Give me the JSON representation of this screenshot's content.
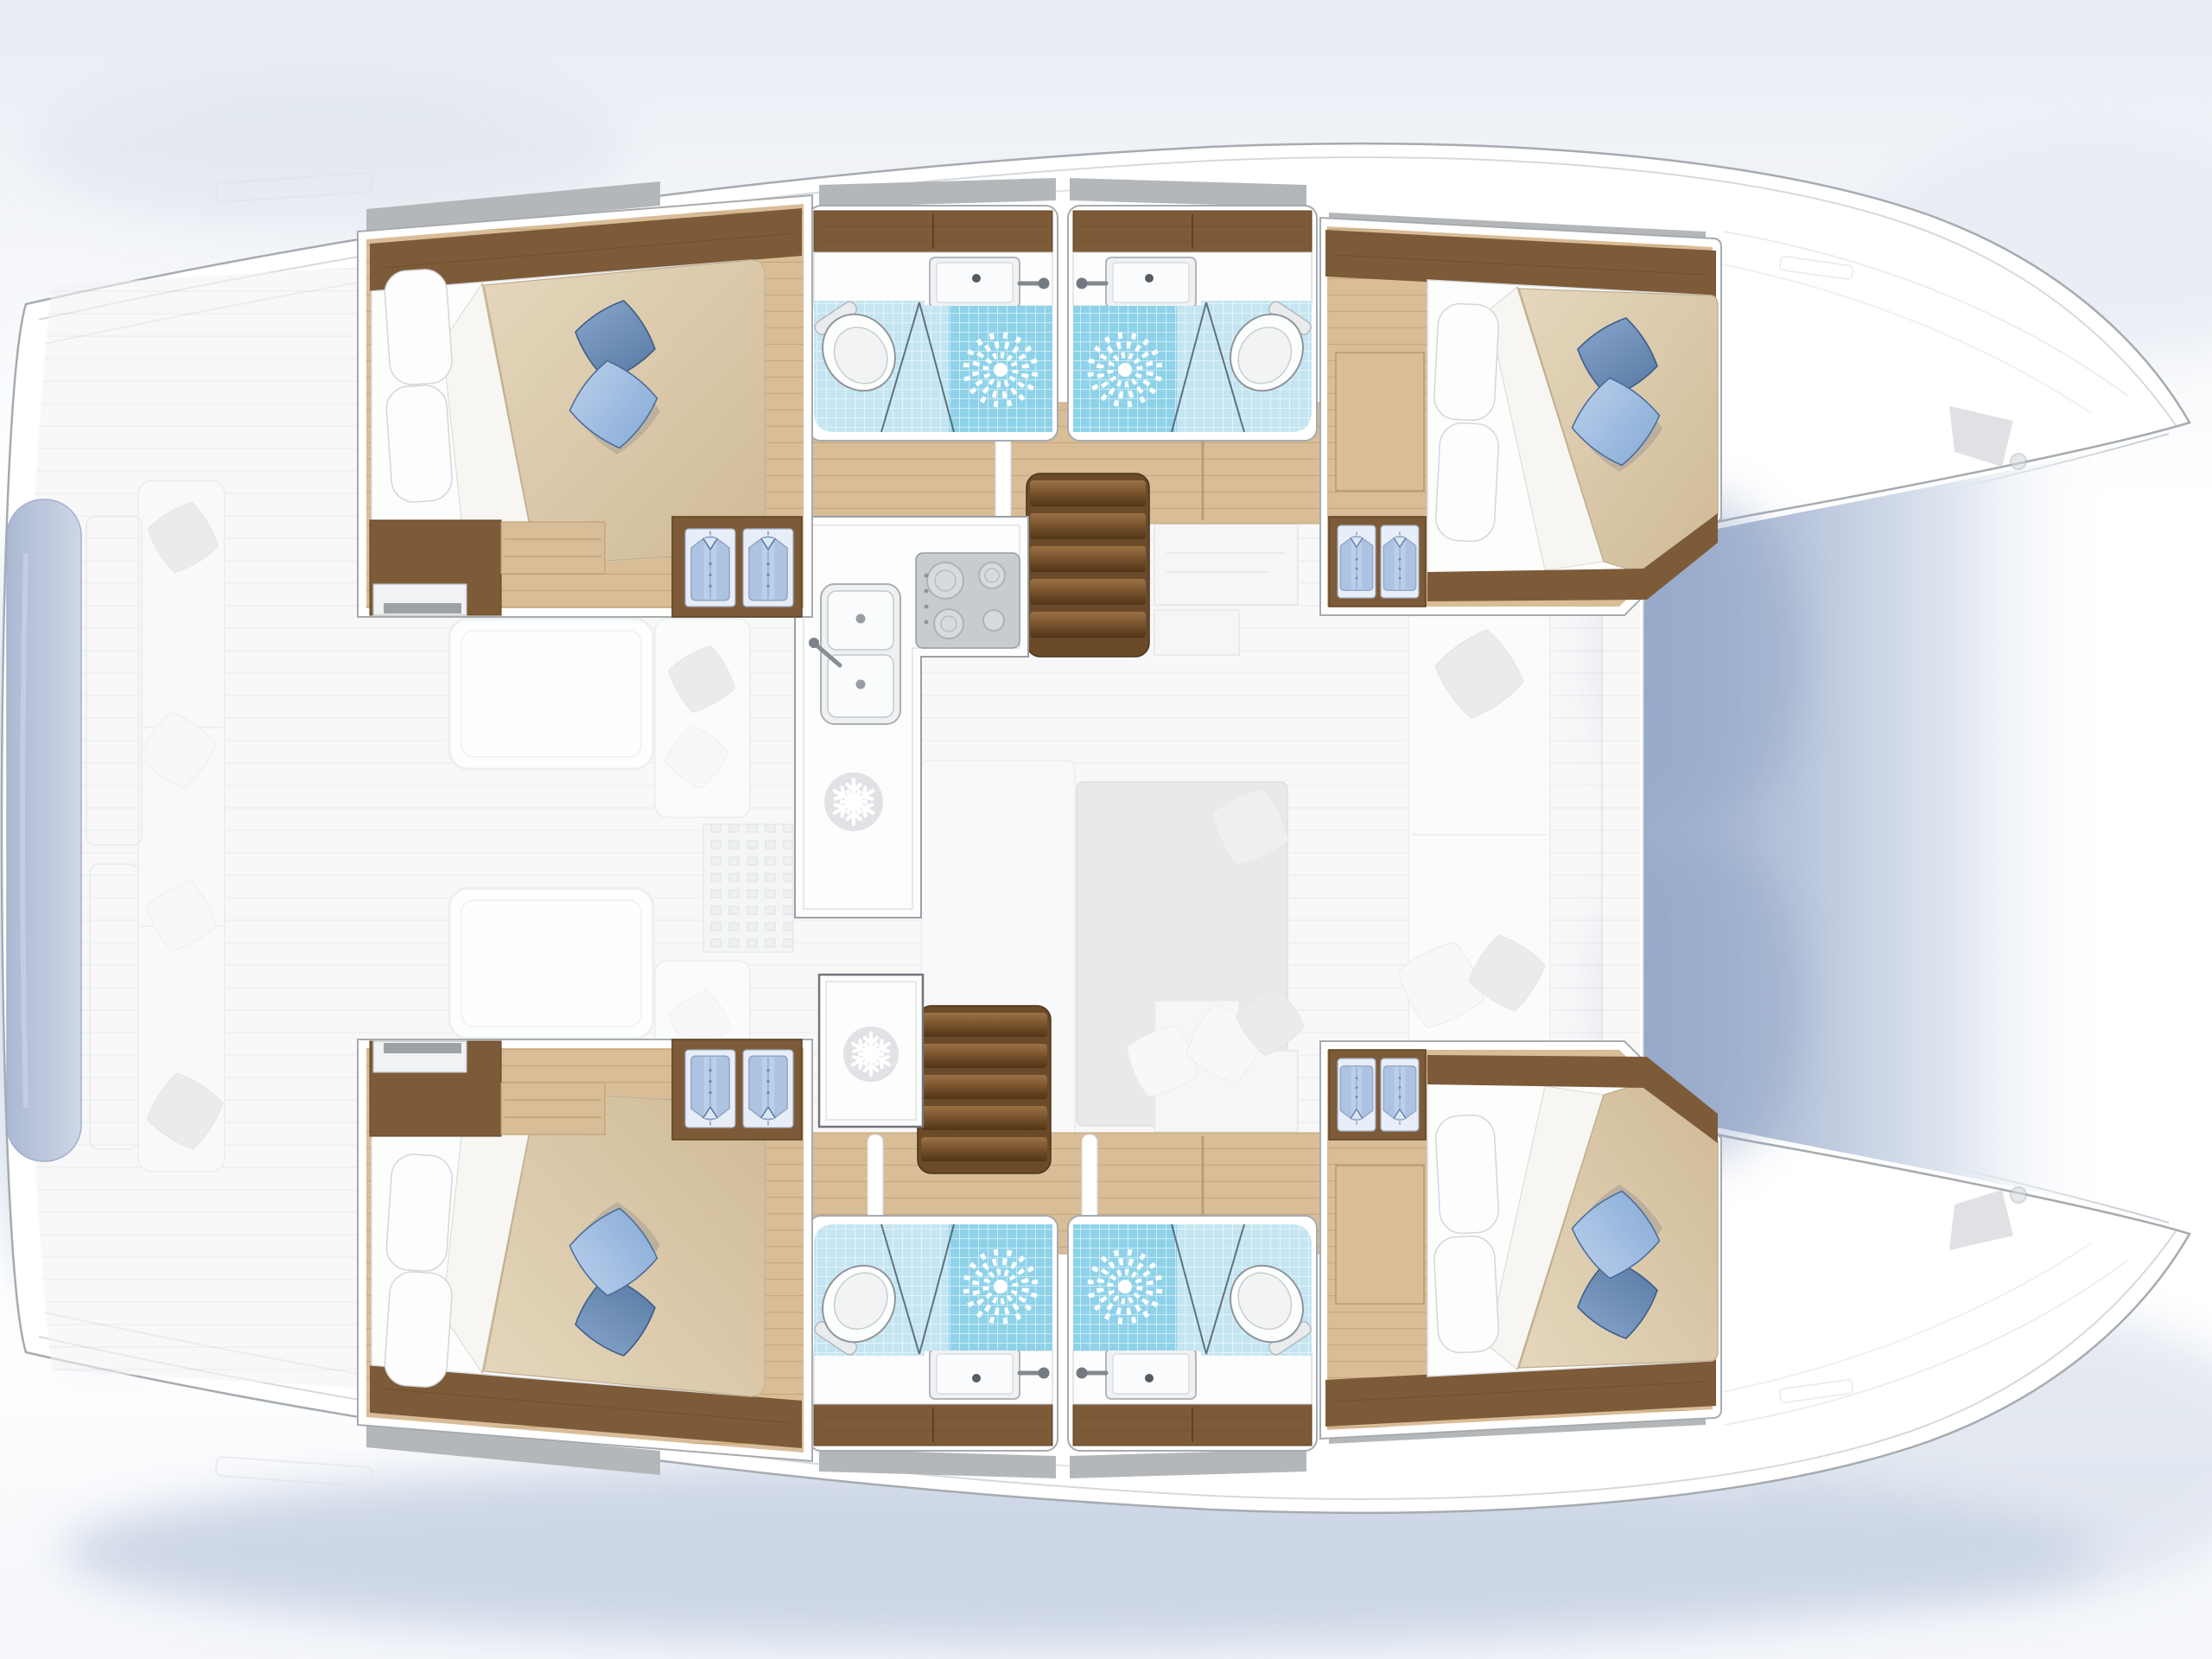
{
  "diagram": {
    "type": "boat-floor-plan",
    "vessel": "sailing catamaran, top-down interior layout, bows pointing right",
    "visible_text": "",
    "counts": {
      "double_cabins": 4,
      "bathrooms": 4,
      "toilets": 4,
      "showers": 4,
      "bathroom_sinks": 4,
      "galley_sink_basins": 2,
      "cooktop_burners": 4,
      "refrigerator_icons": 2,
      "wardrobes": 4,
      "hanging_shirts": 8,
      "companionway_stairs": 2
    }
  },
  "rooms_map": {
    "boat": "Catamaran interior floor plan with 4 double cabins and 4 bathrooms",
    "cabin-port-aft": "Port aft double cabin",
    "cabin-port-fwd": "Port forward double cabin",
    "cabin-stbd-aft": "Starboard aft double cabin",
    "cabin-stbd-fwd": "Starboard forward double cabin",
    "head-port-aft": "Port aft bathroom with sink, toilet and shower",
    "head-port-fwd": "Port forward bathroom with sink, toilet and shower",
    "head-stbd-aft": "Starboard aft bathroom with sink, toilet and shower",
    "head-stbd-fwd": "Starboard forward bathroom with sink, toilet and shower",
    "galley": "Galley with double sink, four-burner cooktop and refrigerator",
    "freezer": "Freezer cabinet",
    "stairs-port": "Companionway steps to port hull",
    "stairs-starboard": "Companionway steps to starboard hull",
    "corridor-port": "Port hull passageway",
    "corridor-starboard": "Starboard hull passageway",
    "saloon": "Saloon table and seating, deck level (ghosted)",
    "cockpit": "Aft cockpit bench and helm (ghosted)",
    "foredeck": "Foredeck and bows (ghosted hardware)",
    "tender": "Tender / transom platform (ghosted)"
  },
  "icons": [
    {
      "name": "snowflake-icon",
      "meaning": "refrigerator / freezer"
    },
    {
      "name": "sunburst-icon",
      "meaning": "shower drain"
    },
    {
      "name": "shirt-icon",
      "meaning": "hanging locker (wardrobe)"
    },
    {
      "name": "toilet-icon",
      "meaning": "marine toilet"
    }
  ],
  "colors": {
    "sky": "#e8ecf3",
    "hull_fill": "#ffffff",
    "hull_stroke": "#a6abb0",
    "deck_line": "#d6d9dc",
    "roof_strip": "#b4b7ba",
    "ghost_fill": "#f3f4f6",
    "ghost_stroke": "#dfe2e6",
    "ghost_dark": "#dcdee1",
    "ghost_table": "#d8dbde",
    "water_deep": "#9caecd",
    "water_mid": "#b6c3da",
    "wood_dark": "#7d5b38",
    "wood_dark_edge": "#5c421f",
    "stair_base": "#6b4a29",
    "floor_wood": "#d9bd97",
    "plank_line": "#c3a478",
    "tile": "#c4e5f1",
    "tile_shower": "#8ed2e9",
    "counter": "#fdfdfe",
    "counter_stroke": "#9ba0a5",
    "appliance": "#c9cccf",
    "duvet": "#d7c5a7",
    "duvet_deep": "#cfba96",
    "pillow_blue": "#84a9d6",
    "pillow_blue_deep": "#54779f",
    "pillow_blue_light": "#bdd1ec",
    "shirt": "#b9cfec",
    "dinghy": "#a7b5d0"
  }
}
